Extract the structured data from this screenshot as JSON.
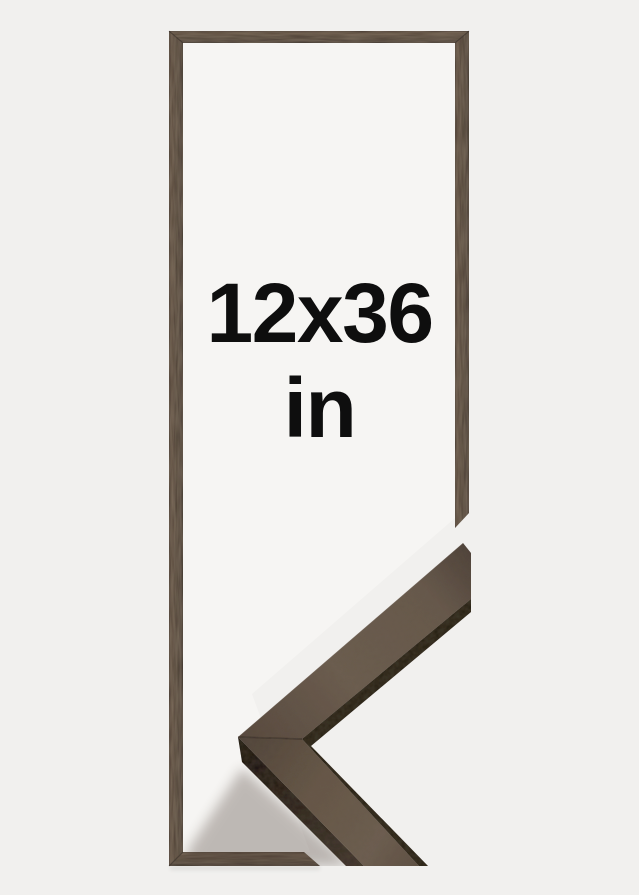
{
  "product_image": {
    "size_label": "12x36",
    "unit_label": "in"
  },
  "colors": {
    "background": "#f1f0ee",
    "frame_interior": "#f6f5f3",
    "frame_wood_dark": "#4a3d33",
    "frame_wood_edge": "#332a23",
    "corner_wood": "#6b5c50",
    "corner_side_dark": "#251d16",
    "label_text": "#0e0e0e"
  }
}
